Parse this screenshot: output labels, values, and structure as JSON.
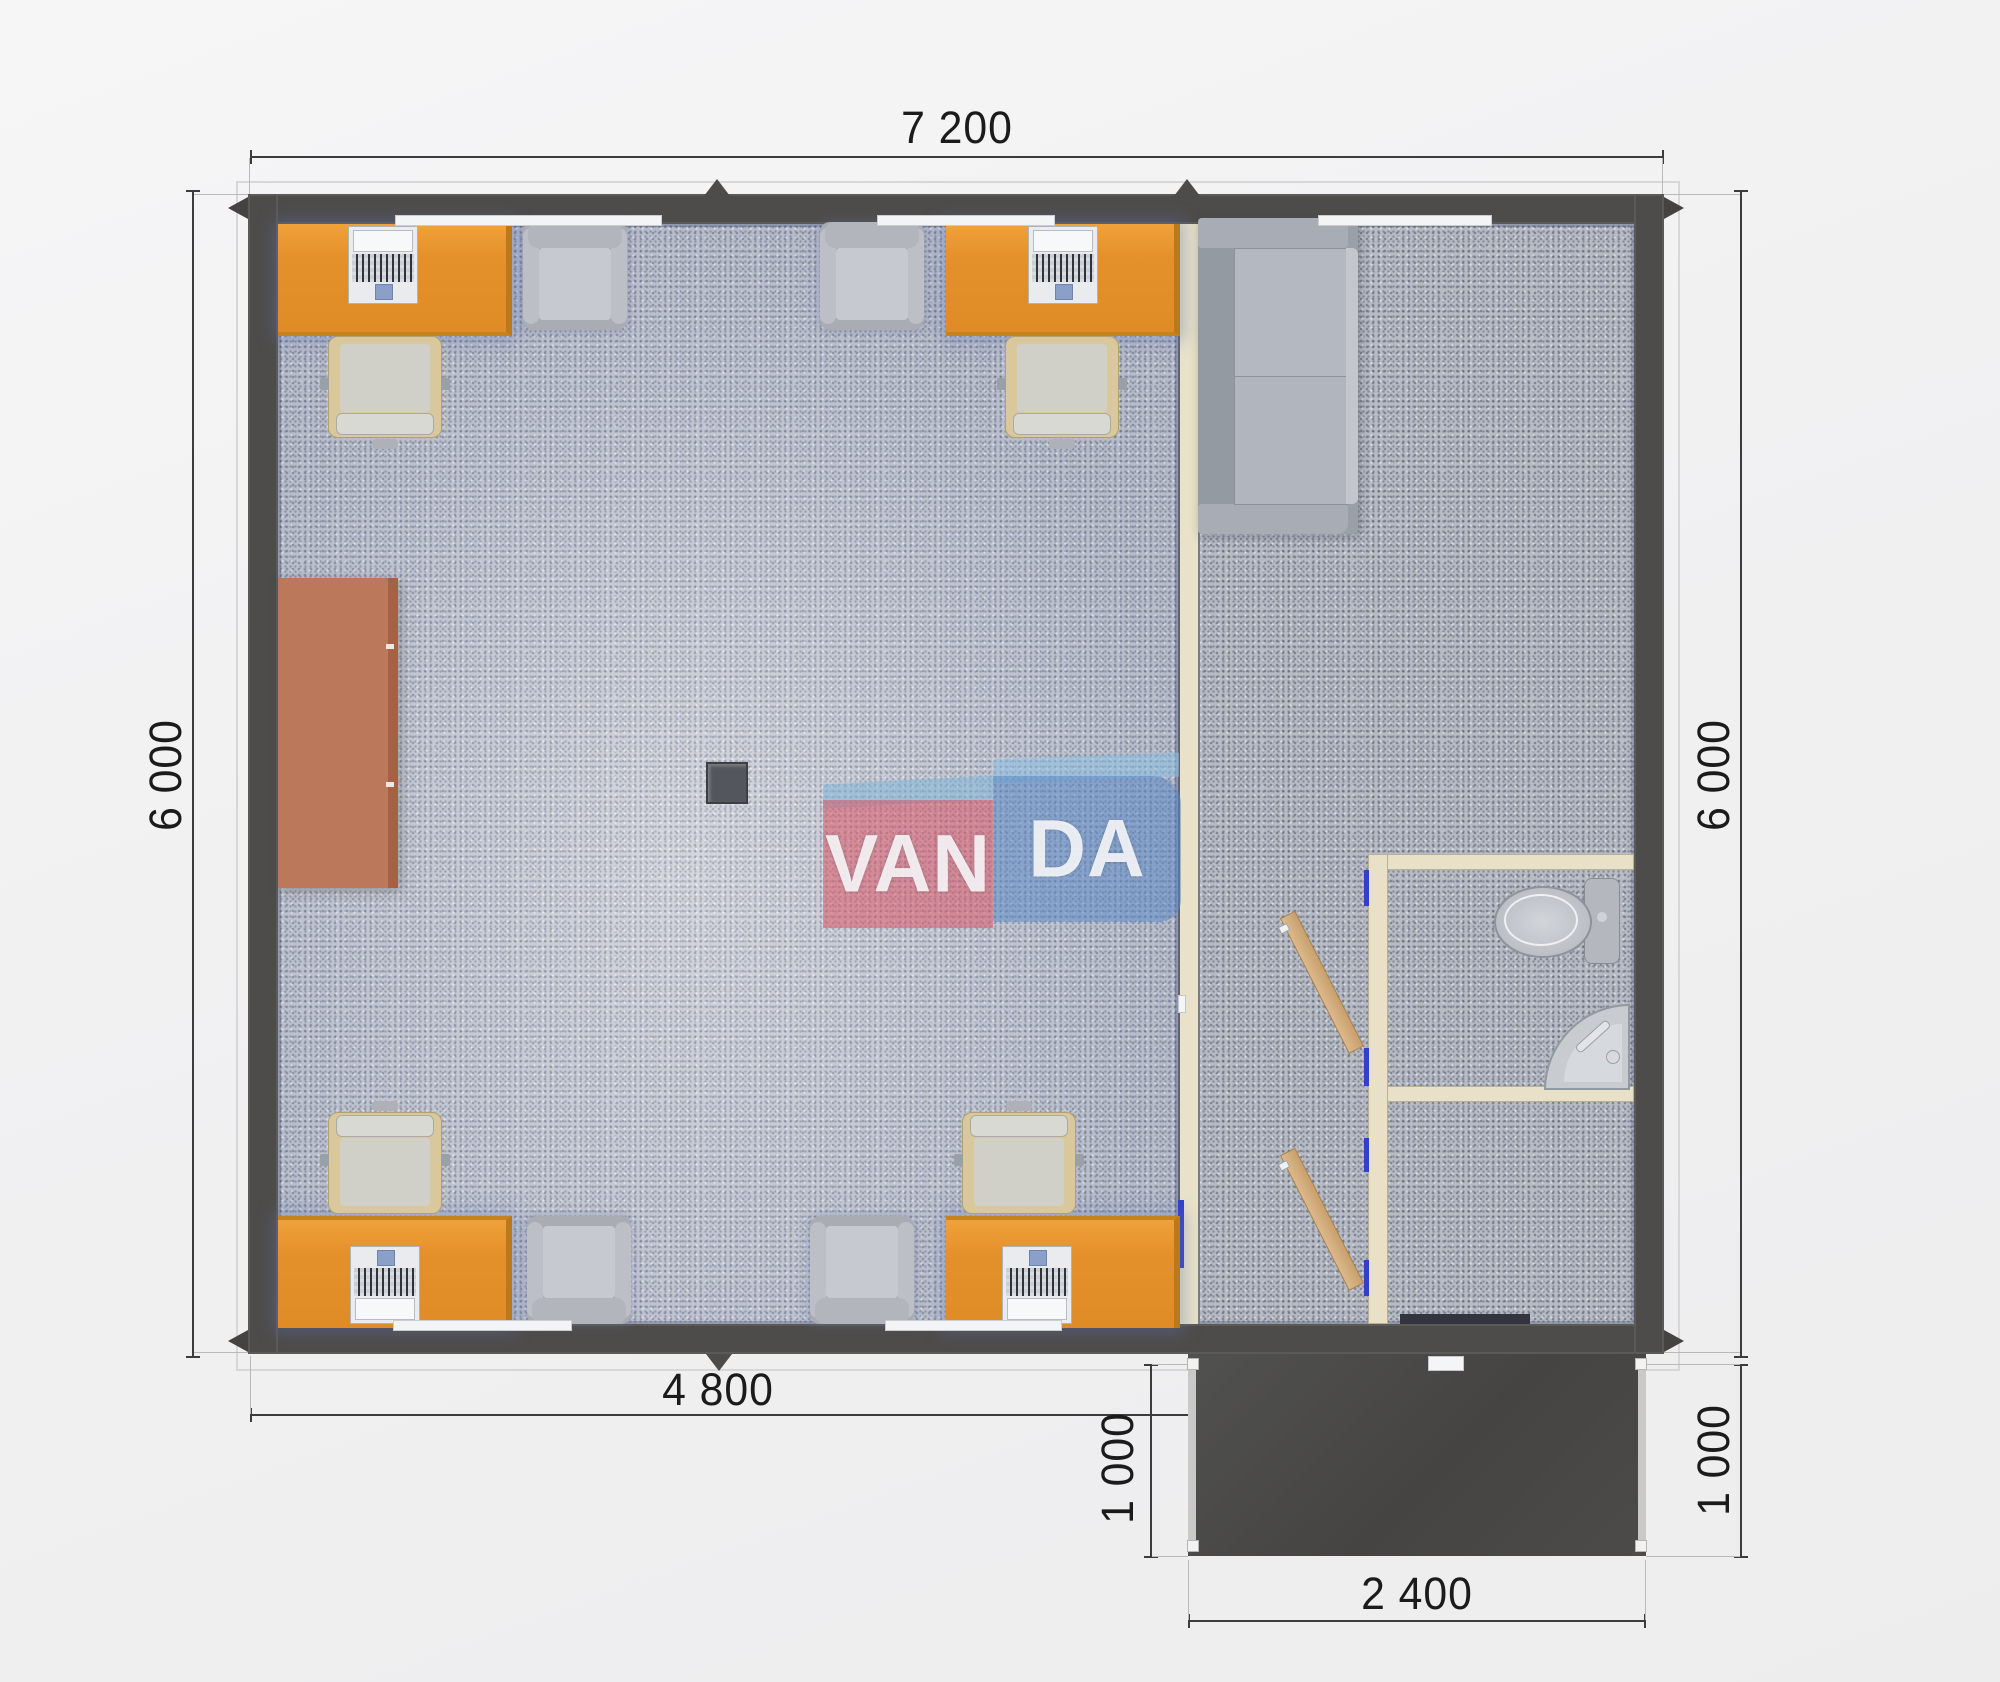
{
  "scene": {
    "type": "architectural floor plan, top-down 3D render",
    "subject": "modular office unit with lounge, WC and entrance porch"
  },
  "watermark": {
    "left_text": "VAN",
    "right_text": "DA",
    "pink_color": "#dd505f",
    "blue_color": "#5686c6"
  },
  "dimensions": {
    "top": "7 200",
    "left": "6 000",
    "right": "6 000",
    "bottom": "4 800",
    "porch_bottom": "2 400",
    "porch_left": "1 000",
    "porch_right": "1 000"
  },
  "colors": {
    "wall_grey": "#4e4c4a",
    "carpet_office": "#c1c5cf",
    "carpet_right_zone": "#b7bbc4",
    "desk_orange": "#e5912b",
    "partition_cream": "#e9e2c9",
    "door_frame_blue": "#3340c8",
    "door_leaf_tan": "#d2ad7e",
    "porch_dark": "#4b4a48",
    "sideboard_brown": "#bc785a"
  },
  "furniture": {
    "workstation_desks": 4,
    "laptops": 4,
    "desk_chairs": 4,
    "guest_armchairs": 4,
    "sofa": 1,
    "sideboard": 1,
    "toilet": 1,
    "corner_sink": 1,
    "interior_door_leaves": 2,
    "stove_unit": 1
  }
}
